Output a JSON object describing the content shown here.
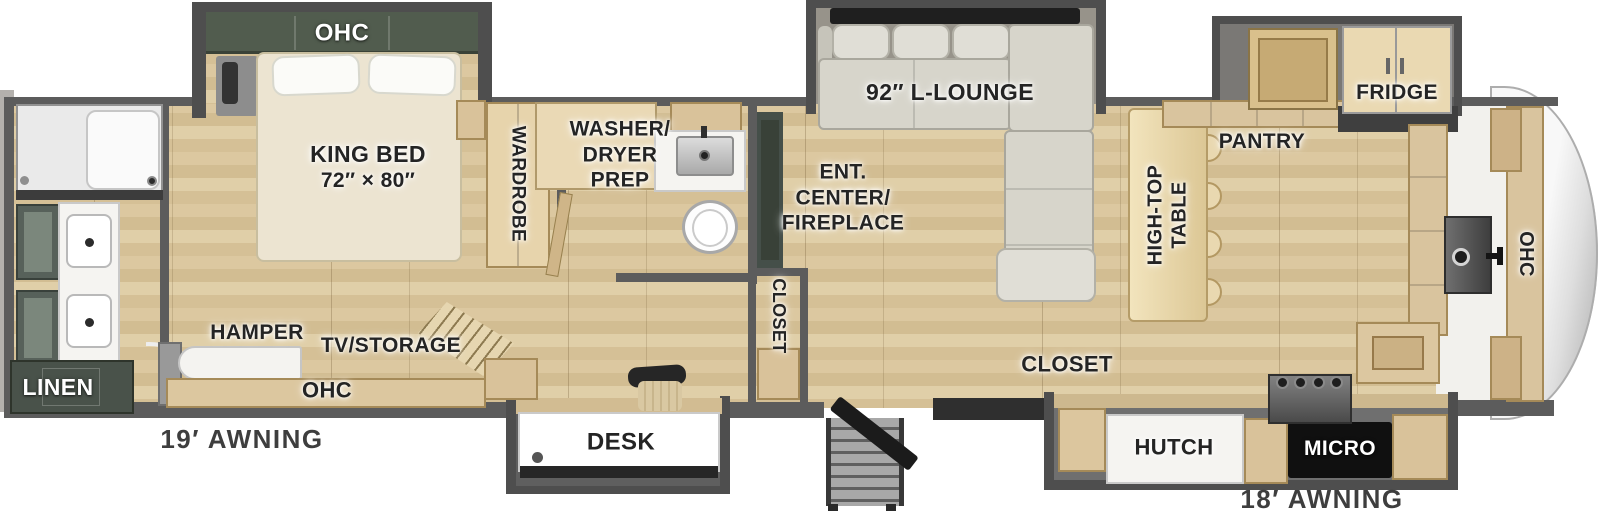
{
  "floorplan": {
    "labels": {
      "bedroom_ohc": "OHC",
      "king_bed_line1": "KING BED",
      "king_bed_line2": "72″ × 80″",
      "wardrobe": "WARDROBE",
      "washer_dryer_line1": "WASHER/",
      "washer_dryer_line2": "DRYER",
      "washer_dryer_line3": "PREP",
      "lounge": "92″ L-LOUNGE",
      "fridge": "FRIDGE",
      "pantry": "PANTRY",
      "high_top_line1": "HIGH-TOP",
      "high_top_line2": "TABLE",
      "ent_center_line1": "ENT.",
      "ent_center_line2": "CENTER/",
      "ent_center_line3": "FIREPLACE",
      "hall_closet": "CLOSET",
      "front_ohc": "OHC",
      "linen": "LINEN",
      "hamper": "HAMPER",
      "tv_storage": "TV/STORAGE",
      "dresser_ohc": "OHC",
      "awning_left": "19′ AWNING",
      "desk": "DESK",
      "entry_closet": "CLOSET",
      "hutch": "HUTCH",
      "micro": "MICRO",
      "awning_right": "18′ AWNING"
    },
    "colors": {
      "wall": "#5c5c5c",
      "slide_wall": "#4e4e4e",
      "floor_wood": "#d8c49c",
      "cabinet_wood": "#d9c29a",
      "green_cabinet": "#515c4e",
      "sofa_gray": "#d7d5cb",
      "label_ink": "#242424"
    }
  }
}
